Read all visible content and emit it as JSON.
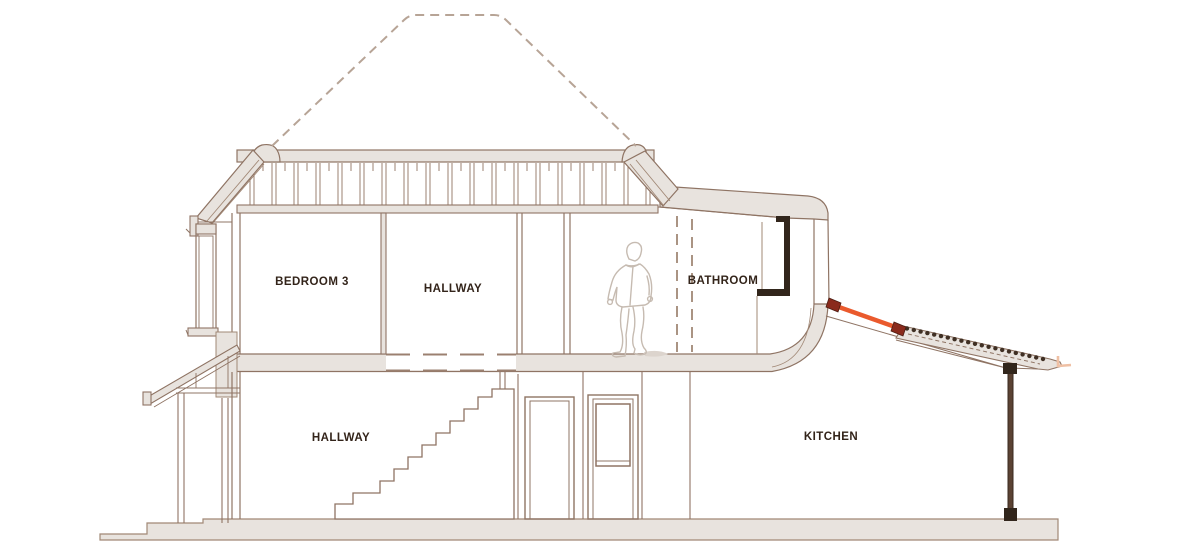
{
  "drawing": {
    "kind": "house-cross-section",
    "labels": {
      "upper": [
        {
          "label": "BEDROOM 3"
        },
        {
          "label": "HALLWAY"
        },
        {
          "label": "BATHROOM"
        }
      ],
      "lower": [
        {
          "label": "HALLWAY"
        },
        {
          "label": "KITCHEN"
        }
      ]
    },
    "colors": {
      "line": "#8f7464",
      "line_soft": "#a18876",
      "wall_fill": "#e8e3de",
      "dark_frame": "#32261c",
      "post_brown": "#5b4233",
      "accent_orange": "#ea5a2d",
      "accent_red": "#8a2a1c",
      "hidden_line": "#b7a496",
      "figure_line": "#c6bbb1",
      "label_text": "#33241a"
    },
    "elements": {
      "figure": "person-outline",
      "strut": "orange-strut",
      "glazing": "sloped-glazed-roof",
      "hidden_roof": "dashed-roof-outline"
    }
  }
}
